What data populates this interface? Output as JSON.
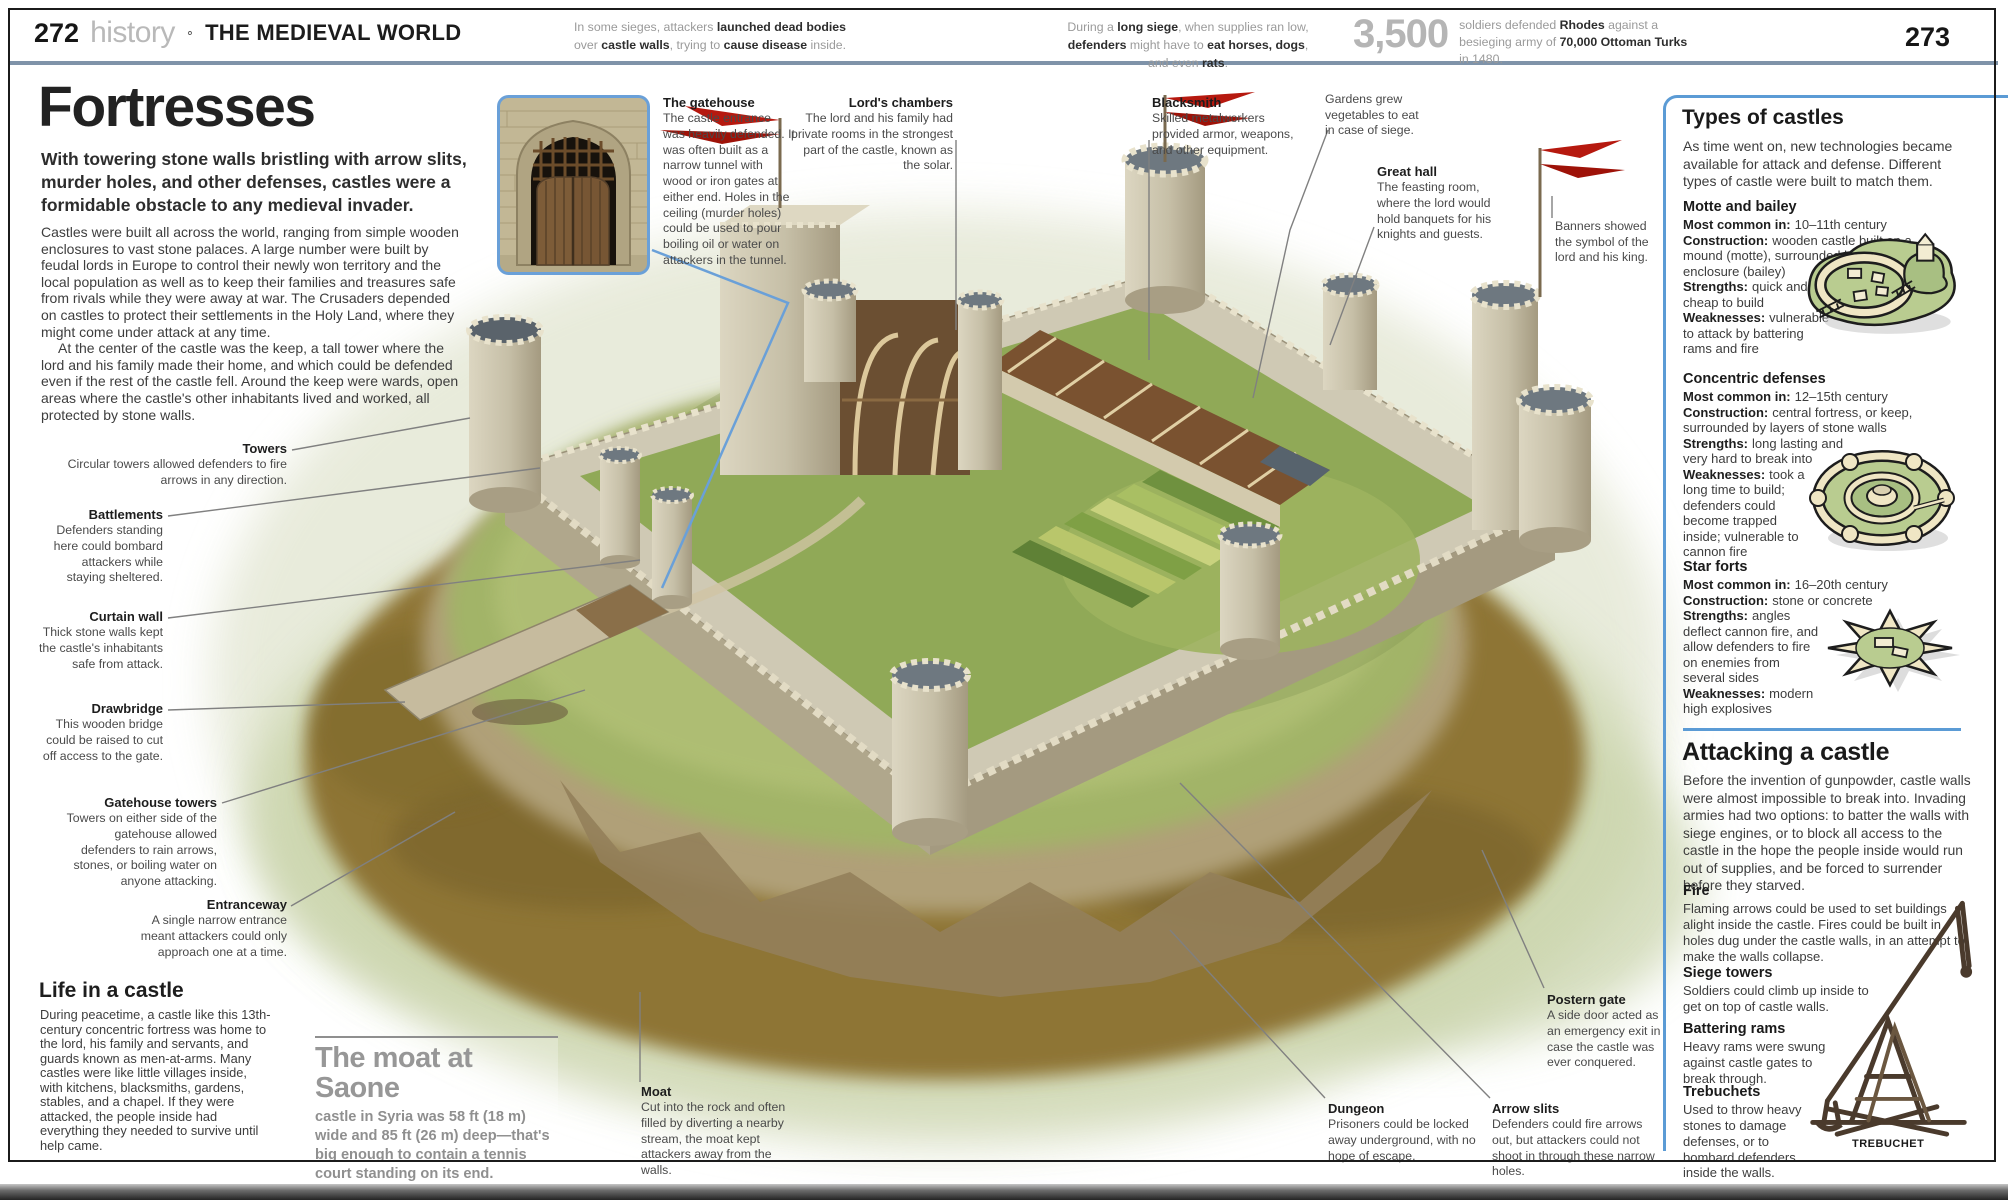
{
  "header": {
    "page_left": "272",
    "section": "history",
    "separator": "∘",
    "chapter": "THE MEDIEVAL WORLD",
    "page_right": "273",
    "factoid1": {
      "segs": [
        "In some sieges, attackers ",
        "launched dead bodies",
        " over ",
        "castle walls",
        ", trying to ",
        "cause disease",
        " inside."
      ]
    },
    "factoid2": {
      "segs": [
        "During a ",
        "long siege",
        ", when supplies ran low, ",
        "defenders",
        " might have to ",
        "eat horses, dogs",
        ", and even ",
        "rats",
        "."
      ]
    },
    "stat": {
      "number": "3,500",
      "segs": [
        "soldiers defended ",
        "Rhodes",
        " against a besieging army of ",
        "70,000 Ottoman Turks",
        " in 1480."
      ]
    }
  },
  "intro": {
    "title": "Fortresses",
    "standfirst": "With towering stone walls bristling with arrow slits, murder holes, and other defenses, castles were a formidable obstacle to any medieval invader.",
    "para1": "Castles were built all across the world, ranging from simple wooden enclosures to vast stone palaces. A large number were built by feudal lords in Europe to control their newly won territory and the local population as well as to keep their families and treasures safe from rivals while they were away at war. The Crusaders depended on castles to protect their settlements in the Holy Land, where they might come under attack at any time.",
    "para2": "At the center of the castle was the keep, a tall tower where the lord and his family made their home, and which could be defended even if the rest of the castle fell. Around the keep were wards, open areas where the castle's other inhabitants lived and worked, all protected by stone walls."
  },
  "annotations": {
    "towers": {
      "title": "Towers",
      "text": "Circular towers allowed defenders to fire arrows in any direction."
    },
    "battlements": {
      "title": "Battlements",
      "text": "Defenders standing here could bombard attackers while staying sheltered."
    },
    "curtain_wall": {
      "title": "Curtain wall",
      "text": "Thick stone walls kept the castle's inhabitants safe from attack."
    },
    "drawbridge": {
      "title": "Drawbridge",
      "text": "This wooden bridge could be raised to cut off access to the gate."
    },
    "gatehouse_towers": {
      "title": "Gatehouse towers",
      "text": "Towers on either side of the gatehouse allowed defenders to rain arrows, stones, or boiling water on anyone attacking."
    },
    "entranceway": {
      "title": "Entranceway",
      "text": "A single narrow entrance meant attackers could only approach one at a time."
    },
    "gatehouse": {
      "title": "The gatehouse",
      "text": "The castle entrance was heavily defended. It was often built as a narrow tunnel with wood or iron gates at either end. Holes in the ceiling (murder holes) could be used to pour boiling oil or water on attackers in the tunnel."
    },
    "lords_chambers": {
      "title": "Lord's chambers",
      "text": "The lord and his family had private rooms in the strongest part of the castle, known as the solar."
    },
    "blacksmith": {
      "title": "Blacksmith",
      "text": "Skilled metalworkers provided armor, weapons, and other equipment."
    },
    "gardens": {
      "text": "Gardens grew vegetables to eat in case of siege."
    },
    "great_hall": {
      "title": "Great hall",
      "text": "The feasting room, where the lord would hold banquets for his knights and guests."
    },
    "banners": {
      "text": "Banners showed the symbol of the lord and his king."
    },
    "moat": {
      "title": "Moat",
      "text": "Cut into the rock and often filled by diverting a nearby stream, the moat kept attackers away from the walls."
    },
    "dungeon": {
      "title": "Dungeon",
      "text": "Prisoners could be locked away underground, with no hope of escape."
    },
    "arrow_slits": {
      "title": "Arrow slits",
      "text": "Defenders could fire arrows out, but attackers could not shoot in through these narrow holes."
    },
    "postern_gate": {
      "title": "Postern gate",
      "text": "A side door acted as an emergency exit in case the castle was ever conquered."
    }
  },
  "life": {
    "title": "Life in a castle",
    "text": "During peacetime, a castle like this 13th-century concentric fortress was home to the lord, his family and servants, and guards known as men-at-arms. Many castles were like little villages inside, with kitchens, blacksmiths, gardens, stables, and a chapel. If they were attacked, the people inside had everything they needed to survive until help came."
  },
  "moat_callout": {
    "title": "The moat at Saone",
    "text": "castle in Syria was 58 ft (18 m) wide and 85 ft (26 m) deep—that's big enough to contain a tennis court standing on its end."
  },
  "sidebar": {
    "types": {
      "title": "Types of castles",
      "intro": "As time went on, new technologies became available for attack and defense. Different types of castle were built to match them.",
      "motte": {
        "title": "Motte and bailey",
        "fields_wide": [
          {
            "label": "Most common in:",
            "value": "10–11th century"
          },
          {
            "label": "Construction:",
            "value": "wooden castle built on a mound (motte), surrounded by a fortified enclosure (bailey)"
          }
        ],
        "fields_narrow": [
          {
            "label": "Strengths:",
            "value": "quick and cheap to build"
          },
          {
            "label": "Weaknesses:",
            "value": "vulnerable to attack by battering rams and fire"
          }
        ]
      },
      "concentric": {
        "title": "Concentric defenses",
        "fields_wide": [
          {
            "label": "Most common in:",
            "value": "12–15th century"
          },
          {
            "label": "Construction:",
            "value": "central fortress, or keep, surrounded by layers of stone walls"
          },
          {
            "label": "Strengths:",
            "value": "long lasting and very hard to break into"
          }
        ],
        "fields_narrow": [
          {
            "label": "Weaknesses:",
            "value": "took a long time to build; defenders could become trapped inside; vulnerable to cannon fire"
          }
        ]
      },
      "star": {
        "title": "Star forts",
        "fields_wide": [
          {
            "label": "Most common in:",
            "value": "16–20th century"
          },
          {
            "label": "Construction:",
            "value": "stone or concrete"
          }
        ],
        "fields_narrow": [
          {
            "label": "Strengths:",
            "value": "angles deflect cannon fire, and allow defenders to fire on enemies from several sides"
          },
          {
            "label": "Weaknesses:",
            "value": "modern high explosives"
          }
        ]
      }
    },
    "attacking": {
      "title": "Attacking a castle",
      "intro": "Before the invention of gunpowder, castle walls were almost impossible to break into. Invading armies had two options: to batter the walls with siege engines, or to block all access to the castle in the hope the people inside would run out of supplies, and be forced to surrender before they starved.",
      "fire": {
        "title": "Fire",
        "text": "Flaming arrows could be used to set buildings alight inside the castle. Fires could be built in holes dug under the castle walls, in an attempt to make the walls collapse."
      },
      "siege_towers": {
        "title": "Siege towers",
        "text": "Soldiers could climb up inside to get on top of castle walls."
      },
      "battering_rams": {
        "title": "Battering rams",
        "text": "Heavy rams were swung against castle gates to break through."
      },
      "trebuchets": {
        "title": "Trebuchets",
        "text": "Used to throw heavy stones to damage defenses, or to bombard defenders inside the walls."
      },
      "caption": "TREBUCHET"
    }
  },
  "colors": {
    "accent_blue": "#5b9bd5",
    "rule_slate": "#7f93a9",
    "flag_red": "#b6190f"
  }
}
